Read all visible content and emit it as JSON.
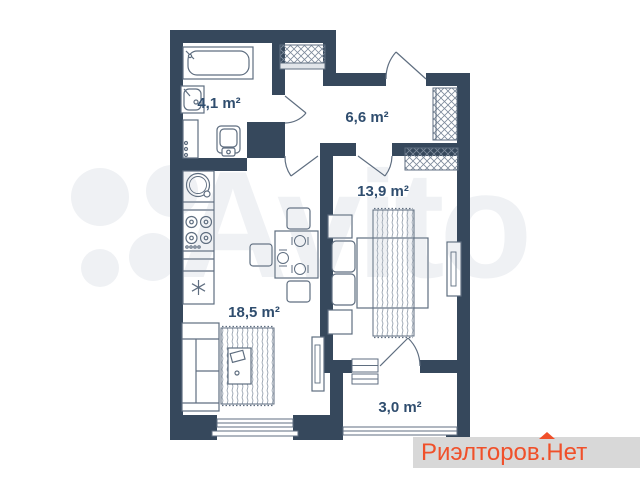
{
  "floor_plan": {
    "wall_color": "#36485c",
    "furniture_line_color": "#5f6e80",
    "label_color": "#2f4d6e",
    "rooms": [
      {
        "name": "bathroom",
        "area_label": "4,1 m²"
      },
      {
        "name": "hallway",
        "area_label": "6,6 m²"
      },
      {
        "name": "bedroom",
        "area_label": "13,9 m²"
      },
      {
        "name": "living-kitchen",
        "area_label": "18,5 m²"
      },
      {
        "name": "balcony",
        "area_label": "3,0 m²"
      }
    ]
  },
  "watermark": {
    "text": "Avito",
    "color": "#eff1f4"
  },
  "brand": {
    "text": "Риэлторов.Нет",
    "color": "#f0502a",
    "band_color": "#d8d8d8"
  }
}
